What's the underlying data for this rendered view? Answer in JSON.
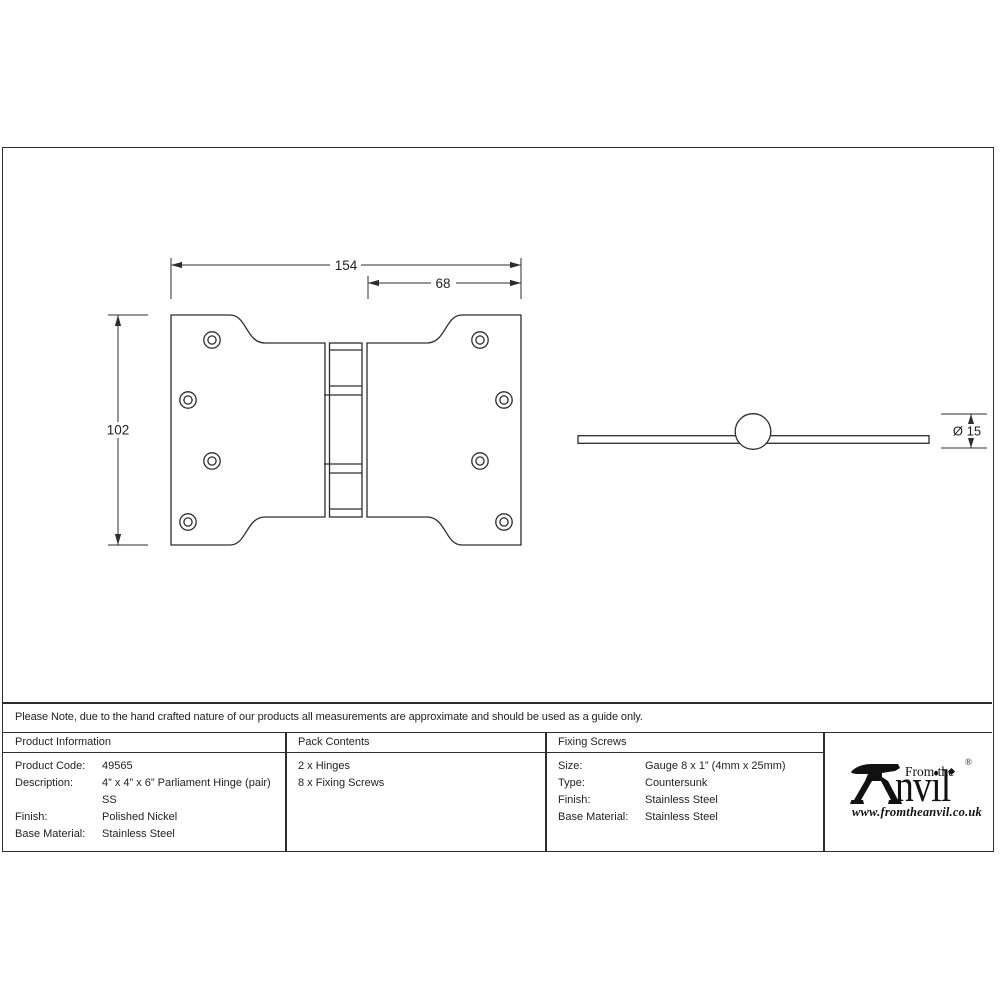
{
  "drawing": {
    "front_view": {
      "width_total": "154",
      "width_right_leaf": "68",
      "height": "102"
    },
    "side_view": {
      "knuckle_diameter": "Ø 15"
    }
  },
  "note": "Please Note, due to the hand crafted nature of our products all measurements are approximate and should be used as a guide only.",
  "product_information": {
    "header": "Product Information",
    "rows": [
      {
        "label": "Product Code:",
        "lines": [
          "49565"
        ]
      },
      {
        "label": "Description:",
        "lines": [
          "4” x 4” x 6” Parliament Hinge (pair)",
          "SS"
        ]
      },
      {
        "label": "Finish:",
        "lines": [
          "Polished Nickel"
        ]
      },
      {
        "label": "Base Material:",
        "lines": [
          "Stainless Steel"
        ]
      }
    ]
  },
  "pack_contents": {
    "header": "Pack Contents",
    "items": [
      "2 x Hinges",
      "8 x Fixing Screws"
    ]
  },
  "fixing_screws": {
    "header": "Fixing Screws",
    "rows": [
      {
        "label": "Size:",
        "lines": [
          "Gauge 8 x 1” (4mm x 25mm)"
        ]
      },
      {
        "label": "Type:",
        "lines": [
          "Countersunk"
        ]
      },
      {
        "label": "Finish:",
        "lines": [
          "Stainless Steel"
        ]
      },
      {
        "label": "Base Material:",
        "lines": [
          "Stainless Steel"
        ]
      }
    ]
  },
  "logo": {
    "prefix": "From the",
    "name_rest": "nvil",
    "registered_mark": "®",
    "website": "www.fromtheanvil.co.uk"
  },
  "colors": {
    "ink": "#2d2d2d",
    "text": "#1f1f1f"
  }
}
